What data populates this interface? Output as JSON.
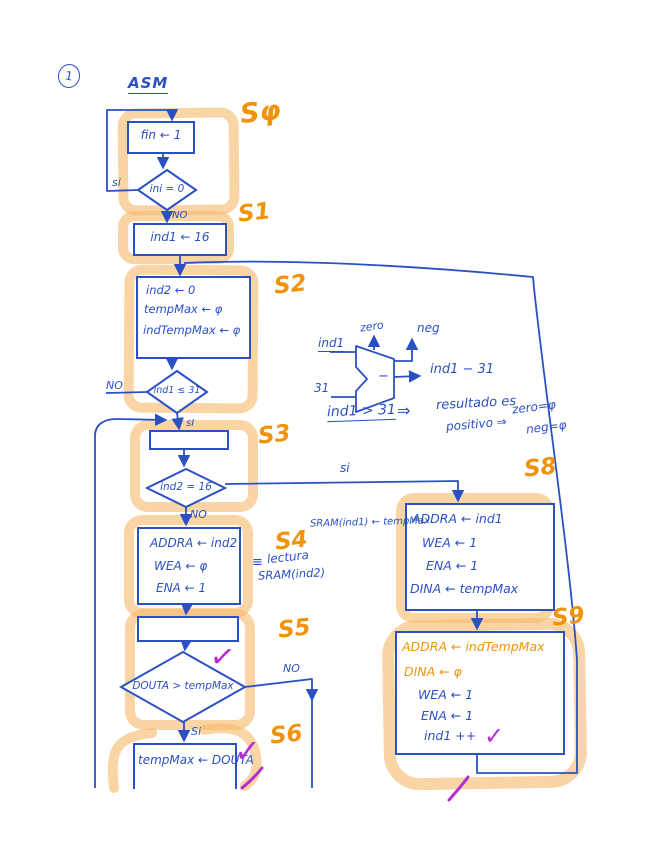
{
  "page": {
    "number": "1",
    "title": "ASM"
  },
  "states": {
    "s0": {
      "label": "Sφ",
      "action": "fin ← 1",
      "condition": "ini = 0",
      "yes": "si",
      "no": "NO"
    },
    "s1": {
      "label": "S1",
      "action": "ind1 ← 16"
    },
    "s2": {
      "label": "S2",
      "lines": [
        "ind2 ← 0",
        "tempMax ← φ",
        "indTempMax ← φ"
      ],
      "condition": "ind1 ≤ 31",
      "yes": "sI",
      "no": "NO"
    },
    "s3": {
      "label": "S3",
      "condition": "ind2 = 16",
      "yes": "si",
      "no": "NO"
    },
    "s4": {
      "label": "S4",
      "lines": [
        "ADDRA ← ind2",
        "WEA ← φ",
        "ENA ← 1"
      ],
      "note_sign": "≡",
      "note_line1": "lectura",
      "note_line2": "SRAM(ind2)"
    },
    "s5": {
      "label": "S5",
      "condition": "DOUTA > tempMax",
      "yes": "Si",
      "no": "NO"
    },
    "s6": {
      "label": "S6",
      "action": "tempMax ← DOUTA"
    },
    "s8": {
      "label": "S8",
      "lines": [
        "ADDRA ← ind1",
        "WEA ← 1",
        "ENA ← 1",
        "DINA ← tempMax"
      ],
      "note": "SRAM(ind1) ← tempMax"
    },
    "s9": {
      "label": "S9",
      "lines_orange": [
        "ADDRA ← indTempMax",
        "DINA ← φ"
      ],
      "lines_blue": [
        "WEA ← 1",
        "ENA ← 1",
        "ind1 ++"
      ]
    }
  },
  "alu": {
    "input_top": "ind1",
    "input_bottom": "31",
    "op": "−",
    "output_zero": "zero",
    "output_neg": "neg",
    "output_result": "ind1 − 31",
    "equation": {
      "lhs": "ind1 > 31",
      "arrow": "⇒",
      "line1": "resultado es",
      "line2": "positivo ⇒",
      "result1": "zero=φ",
      "result2": "neg=φ"
    }
  },
  "marks": {
    "check": "✓"
  },
  "colors": {
    "ink_blue": "#2b50c4",
    "highlighter": "#f5b96a",
    "label_orange": "#f0930c",
    "annotation_purple": "#b12fd2"
  }
}
